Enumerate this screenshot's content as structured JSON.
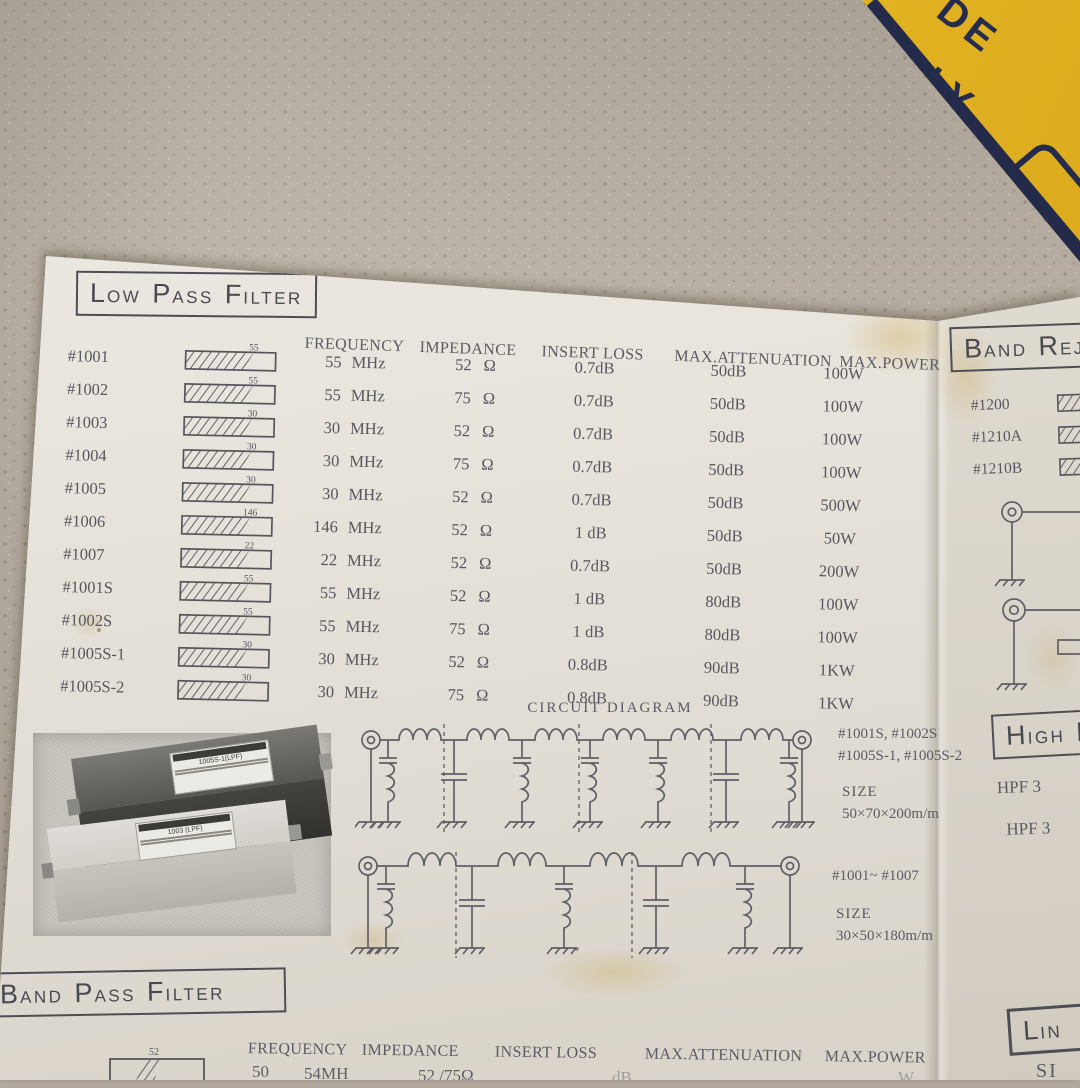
{
  "scene": {
    "yellow_box_text": [
      "DE",
      "PLY"
    ]
  },
  "low_pass": {
    "title_parts": [
      [
        "L",
        "OW"
      ],
      [
        "P",
        "ASS"
      ],
      [
        "F",
        "ILTER"
      ]
    ],
    "headers": [
      "FREQUENCY",
      "IMPEDANCE",
      "INSERT LOSS",
      "MAX.ATTENUATION",
      "MAX.POWER"
    ],
    "rows": [
      {
        "model": "#1001",
        "cutoff": "55",
        "freq": "55",
        "freq_unit": "MHz",
        "impedance": "52",
        "imp_unit": "Ω",
        "insert_loss": "0.7dB",
        "max_attenuation": "50dB",
        "max_power": "100W"
      },
      {
        "model": "#1002",
        "cutoff": "55",
        "freq": "55",
        "freq_unit": "MHz",
        "impedance": "75",
        "imp_unit": "Ω",
        "insert_loss": "0.7dB",
        "max_attenuation": "50dB",
        "max_power": "100W"
      },
      {
        "model": "#1003",
        "cutoff": "30",
        "freq": "30",
        "freq_unit": "MHz",
        "impedance": "52",
        "imp_unit": "Ω",
        "insert_loss": "0.7dB",
        "max_attenuation": "50dB",
        "max_power": "100W"
      },
      {
        "model": "#1004",
        "cutoff": "30",
        "freq": "30",
        "freq_unit": "MHz",
        "impedance": "75",
        "imp_unit": "Ω",
        "insert_loss": "0.7dB",
        "max_attenuation": "50dB",
        "max_power": "100W"
      },
      {
        "model": "#1005",
        "cutoff": "30",
        "freq": "30",
        "freq_unit": "MHz",
        "impedance": "52",
        "imp_unit": "Ω",
        "insert_loss": "0.7dB",
        "max_attenuation": "50dB",
        "max_power": "500W"
      },
      {
        "model": "#1006",
        "cutoff": "146",
        "freq": "146",
        "freq_unit": "MHz",
        "impedance": "52",
        "imp_unit": "Ω",
        "insert_loss": "1 dB",
        "max_attenuation": "50dB",
        "max_power": "50W"
      },
      {
        "model": "#1007",
        "cutoff": "22",
        "freq": "22",
        "freq_unit": "MHz",
        "impedance": "52",
        "imp_unit": "Ω",
        "insert_loss": "0.7dB",
        "max_attenuation": "50dB",
        "max_power": "200W"
      },
      {
        "model": "#1001S",
        "cutoff": "55",
        "freq": "55",
        "freq_unit": "MHz",
        "impedance": "52",
        "imp_unit": "Ω",
        "insert_loss": "1 dB",
        "max_attenuation": "80dB",
        "max_power": "100W"
      },
      {
        "model": "#1002S",
        "cutoff": "55",
        "freq": "55",
        "freq_unit": "MHz",
        "impedance": "75",
        "imp_unit": "Ω",
        "insert_loss": "1 dB",
        "max_attenuation": "80dB",
        "max_power": "100W"
      },
      {
        "model": "#1005S-1",
        "cutoff": "30",
        "freq": "30",
        "freq_unit": "MHz",
        "impedance": "52",
        "imp_unit": "Ω",
        "insert_loss": "0.8dB",
        "max_attenuation": "90dB",
        "max_power": "1KW"
      },
      {
        "model": "#1005S-2",
        "cutoff": "30",
        "freq": "30",
        "freq_unit": "MHz",
        "impedance": "75",
        "imp_unit": "Ω",
        "insert_loss": "0.8dB",
        "max_attenuation": "90dB",
        "max_power": "1KW"
      }
    ]
  },
  "circuit": {
    "title": "CIRCUIT  DIAGRAM",
    "top": {
      "models_line1": "#1001S, #1002S",
      "models_line2": "#1005S-1, #1005S-2",
      "size_label": "SIZE",
      "size": "50×70×200m/m"
    },
    "bottom": {
      "models": "#1001~ #1007",
      "size_label": "SIZE",
      "size": "30×50×180m/m"
    }
  },
  "photo": {
    "box_labels": [
      "1005S-1(LPF)",
      "1003 (LPF)"
    ]
  },
  "band_reject": {
    "title_parts": [
      [
        "B",
        "AND"
      ],
      [
        "R",
        "EJE"
      ]
    ],
    "items": [
      "#1200",
      "#1210A",
      "#1210B"
    ]
  },
  "high_pass": {
    "title_parts": [
      [
        "H",
        "IGH"
      ],
      [
        "P",
        ""
      ]
    ],
    "items": [
      "HPF 3",
      "HPF 3"
    ]
  },
  "band_pass": {
    "title_parts": [
      [
        "B",
        "AND"
      ],
      [
        "P",
        "ASS"
      ],
      [
        "F",
        "ILTER"
      ]
    ],
    "headers": [
      "FREQUENCY",
      "IMPEDANCE",
      "INSERT LOSS",
      "MAX.ATTENUATION",
      "MAX.POWER"
    ],
    "partial_row": {
      "cutoff": "52",
      "freq_a": "50",
      "freq_b": "54MH",
      "impedance": "52 /75Ω",
      "loss_frag": "dB",
      "power_frag": "W"
    }
  },
  "line_section": {
    "title_parts": [
      [
        "L",
        "IN"
      ]
    ],
    "sub": "SI"
  }
}
